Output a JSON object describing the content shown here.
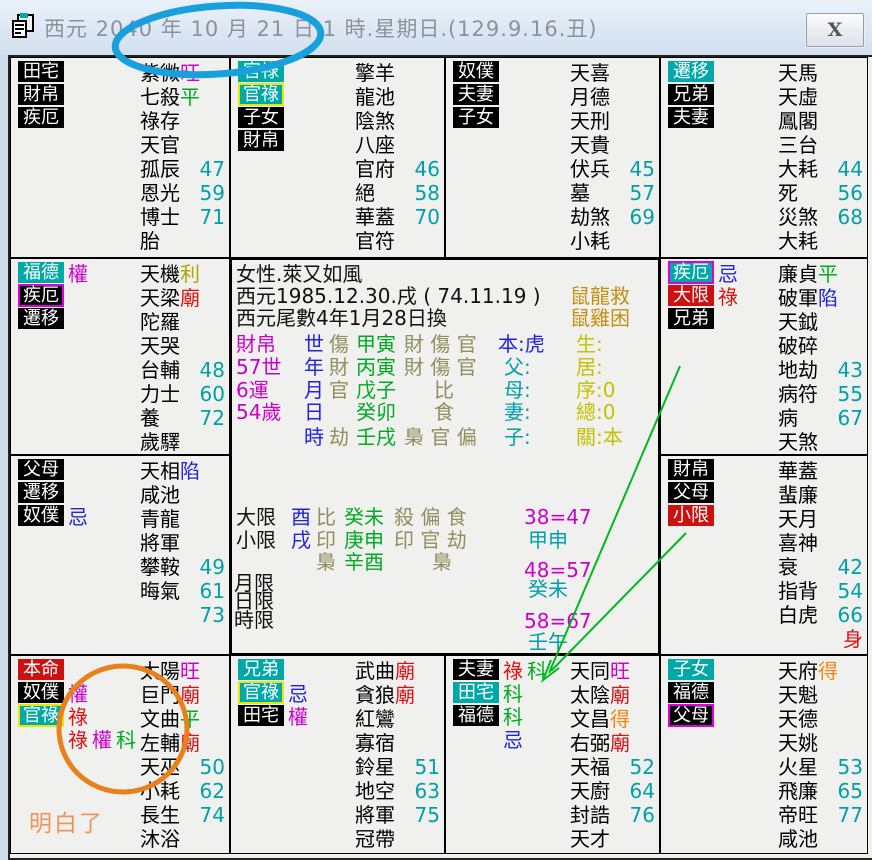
{
  "titlebar": {
    "title": "西元 2040 年 10 月 21 日 1 時.星期日.(129.9.16.丑)",
    "close_label": "X"
  },
  "colors": {
    "black": "#111111",
    "magenta": "#CC00CC",
    "red": "#DD1111",
    "green": "#00AA22",
    "blue": "#2222DD",
    "cyan": "#00A0A8",
    "orange": "#EE8811",
    "olive": "#8F8F5F",
    "gold": "#C09010",
    "yellow": "#C2C200",
    "darkyellow": "#A8A800",
    "noteorange": "#F0955A"
  },
  "annotations": {
    "blue_ellipse_color": "#18A0DC",
    "orange_circle_color": "#E8801E",
    "green_arrow_color": "#00B91E"
  },
  "cells": [
    {
      "id": "si",
      "boxes": [
        {
          "t": "田宅",
          "bg": "black",
          "marks": []
        },
        {
          "t": "財帛",
          "bg": "black",
          "marks": []
        },
        {
          "t": "疾厄",
          "bg": "black",
          "marks": []
        }
      ],
      "stars": [
        {
          "n": "紫微",
          "b": "旺",
          "bc": "magenta"
        },
        {
          "n": "七殺",
          "b": "平",
          "bc": "green"
        },
        {
          "n": "祿存"
        },
        {
          "n": "天官"
        },
        {
          "n": "孤辰",
          "num": "47"
        },
        {
          "n": "恩光",
          "num": "59"
        },
        {
          "n": "博士",
          "num": "71"
        },
        {
          "n": "胎"
        }
      ]
    },
    {
      "id": "wu",
      "boxes": [
        {
          "t": "官祿",
          "bg": "teal",
          "marks": []
        },
        {
          "t": "官祿",
          "bg": "teal",
          "border": "yellow",
          "marks": []
        },
        {
          "t": "子女",
          "bg": "black",
          "marks": []
        },
        {
          "t": "財帛",
          "bg": "black",
          "marks": []
        }
      ],
      "stars": [
        {
          "n": "擎羊"
        },
        {
          "n": "龍池"
        },
        {
          "n": "陰煞"
        },
        {
          "n": "八座"
        },
        {
          "n": "官府",
          "num": "46"
        },
        {
          "n": "絕",
          "num": "58"
        },
        {
          "n": "華蓋",
          "num": "70"
        },
        {
          "n": "官符"
        }
      ]
    },
    {
      "id": "wei",
      "boxes": [
        {
          "t": "奴僕",
          "bg": "black",
          "marks": []
        },
        {
          "t": "夫妻",
          "bg": "black",
          "marks": []
        },
        {
          "t": "子女",
          "bg": "black",
          "marks": []
        }
      ],
      "stars": [
        {
          "n": "天喜"
        },
        {
          "n": "月德"
        },
        {
          "n": "天刑"
        },
        {
          "n": "天貴"
        },
        {
          "n": "伏兵",
          "num": "45"
        },
        {
          "n": "墓",
          "num": "57"
        },
        {
          "n": "劫煞",
          "num": "69"
        },
        {
          "n": "小耗"
        }
      ]
    },
    {
      "id": "shen",
      "boxes": [
        {
          "t": "遷移",
          "bg": "teal",
          "marks": []
        },
        {
          "t": "兄弟",
          "bg": "black",
          "marks": []
        },
        {
          "t": "夫妻",
          "bg": "black",
          "marks": []
        }
      ],
      "stars": [
        {
          "n": "天馬"
        },
        {
          "n": "天虛"
        },
        {
          "n": "鳳閣"
        },
        {
          "n": "三台"
        },
        {
          "n": "大耗",
          "num": "44"
        },
        {
          "n": "死",
          "num": "56"
        },
        {
          "n": "災煞",
          "num": "68"
        },
        {
          "n": "大耗"
        }
      ]
    },
    {
      "id": "chen",
      "boxes": [
        {
          "t": "福德",
          "bg": "teal",
          "marks": [
            {
              "t": "權",
              "c": "magenta"
            }
          ]
        },
        {
          "t": "疾厄",
          "bg": "black",
          "border": "magenta",
          "marks": []
        },
        {
          "t": "遷移",
          "bg": "black",
          "marks": []
        }
      ],
      "stars": [
        {
          "n": "天機",
          "b": "利",
          "bc": "darkyellow"
        },
        {
          "n": "天梁",
          "b": "廟",
          "bc": "red"
        },
        {
          "n": "陀羅"
        },
        {
          "n": "天哭"
        },
        {
          "n": "台輔",
          "num": "48"
        },
        {
          "n": "力士",
          "num": "60"
        },
        {
          "n": "養",
          "num": "72"
        },
        {
          "n": "歲驛"
        }
      ]
    },
    {
      "id": "you",
      "boxes": [
        {
          "t": "疾厄",
          "bg": "teal",
          "border": "magenta",
          "marks": [
            {
              "t": "忌",
              "c": "blue"
            }
          ]
        },
        {
          "t": "大限",
          "bg": "red",
          "marks": [
            {
              "t": "祿",
              "c": "red"
            }
          ]
        },
        {
          "t": "兄弟",
          "bg": "black",
          "marks": []
        }
      ],
      "stars": [
        {
          "n": "廉貞",
          "b": "平",
          "bc": "green"
        },
        {
          "n": "破軍",
          "b": "陷",
          "bc": "blue"
        },
        {
          "n": "天鉞"
        },
        {
          "n": "破碎"
        },
        {
          "n": "地劫",
          "num": "43"
        },
        {
          "n": "病符",
          "num": "55"
        },
        {
          "n": "病",
          "num": "67"
        },
        {
          "n": "天煞"
        }
      ]
    },
    {
      "id": "mao",
      "boxes": [
        {
          "t": "父母",
          "bg": "black",
          "marks": []
        },
        {
          "t": "遷移",
          "bg": "black",
          "marks": []
        },
        {
          "t": "奴僕",
          "bg": "black",
          "marks": [
            {
              "t": "忌",
              "c": "blue"
            }
          ]
        }
      ],
      "stars": [
        {
          "n": "天相",
          "b": "陷",
          "bc": "blue"
        },
        {
          "n": "咸池"
        },
        {
          "n": "青龍"
        },
        {
          "n": "將軍"
        },
        {
          "n": "攀鞍",
          "num": "49"
        },
        {
          "n": "晦氣",
          "num": "61"
        },
        {
          "n": "",
          "num": "73"
        }
      ]
    },
    {
      "id": "xu",
      "boxes": [
        {
          "t": "財帛",
          "bg": "black",
          "marks": []
        },
        {
          "t": "父母",
          "bg": "black",
          "marks": []
        },
        {
          "t": "小限",
          "bg": "red",
          "marks": []
        }
      ],
      "stars": [
        {
          "n": "華蓋"
        },
        {
          "n": "蜚廉"
        },
        {
          "n": "天月"
        },
        {
          "n": "喜神"
        },
        {
          "n": "衰",
          "num": "42"
        },
        {
          "n": "指背",
          "num": "54"
        },
        {
          "n": "白虎",
          "num": "66"
        },
        {
          "n": "",
          "num": "身",
          "numc": "red"
        }
      ]
    },
    {
      "id": "yin",
      "boxes": [
        {
          "t": "本命",
          "bg": "red",
          "marks": []
        },
        {
          "t": "奴僕",
          "bg": "black",
          "marks": [
            {
              "t": "權",
              "c": "magenta"
            }
          ]
        },
        {
          "t": "官祿",
          "bg": "teal",
          "border": "yellow",
          "marks": [
            {
              "t": "祿",
              "c": "red"
            }
          ]
        },
        {
          "bg": "none",
          "marks": [
            {
              "t": "祿",
              "c": "red"
            },
            {
              "t": "權",
              "c": "magenta"
            },
            {
              "t": "科",
              "c": "green"
            }
          ]
        }
      ],
      "note": {
        "t": "明白了",
        "c": "noteorange"
      },
      "stars": [
        {
          "n": "太陽",
          "b": "旺",
          "bc": "magenta"
        },
        {
          "n": "巨門",
          "b": "廟",
          "bc": "red"
        },
        {
          "n": "文曲",
          "b": "平",
          "bc": "green"
        },
        {
          "n": "左輔",
          "b": "廟",
          "bc": "red"
        },
        {
          "n": "天巫",
          "num": "50"
        },
        {
          "n": "小耗",
          "num": "62"
        },
        {
          "n": "長生",
          "num": "74"
        },
        {
          "n": "沐浴"
        }
      ]
    },
    {
      "id": "chou",
      "boxes": [
        {
          "t": "兄弟",
          "bg": "teal",
          "marks": []
        },
        {
          "t": "官祿",
          "bg": "teal",
          "border": "yellow",
          "marks": [
            {
              "t": "忌",
              "c": "blue"
            }
          ]
        },
        {
          "t": "田宅",
          "bg": "black",
          "marks": [
            {
              "t": "權",
              "c": "magenta"
            }
          ]
        }
      ],
      "stars": [
        {
          "n": "武曲",
          "b": "廟",
          "bc": "red"
        },
        {
          "n": "貪狼",
          "b": "廟",
          "bc": "red"
        },
        {
          "n": "紅鸞"
        },
        {
          "n": "寡宿"
        },
        {
          "n": "鈴星",
          "num": "51"
        },
        {
          "n": "地空",
          "num": "63"
        },
        {
          "n": "將軍",
          "num": "75"
        },
        {
          "n": "冠帶"
        }
      ]
    },
    {
      "id": "zi",
      "boxes": [
        {
          "t": "夫妻",
          "bg": "black",
          "marks": [
            {
              "t": "祿",
              "c": "red"
            },
            {
              "t": "科",
              "c": "green"
            }
          ]
        },
        {
          "t": "田宅",
          "bg": "teal",
          "marks": [
            {
              "t": "科",
              "c": "green"
            }
          ]
        },
        {
          "t": "福德",
          "bg": "black",
          "marks": [
            {
              "t": "科",
              "c": "green"
            }
          ]
        },
        {
          "bg": "none",
          "marks": [
            {
              "t": "忌",
              "c": "blue"
            }
          ]
        }
      ],
      "stars": [
        {
          "n": "天同",
          "b": "旺",
          "bc": "magenta"
        },
        {
          "n": "太陰",
          "b": "廟",
          "bc": "red"
        },
        {
          "n": "文昌",
          "b": "得",
          "bc": "orange"
        },
        {
          "n": "右弼",
          "b": "廟",
          "bc": "red"
        },
        {
          "n": "天福",
          "num": "52"
        },
        {
          "n": "天廚",
          "num": "64"
        },
        {
          "n": "封誥",
          "num": "76"
        },
        {
          "n": "天才"
        }
      ]
    },
    {
      "id": "hai",
      "boxes": [
        {
          "t": "子女",
          "bg": "teal",
          "marks": []
        },
        {
          "t": "福德",
          "bg": "black",
          "marks": []
        },
        {
          "t": "父母",
          "bg": "black",
          "border": "magenta",
          "marks": []
        }
      ],
      "stars": [
        {
          "n": "天府",
          "b": "得",
          "bc": "orange"
        },
        {
          "n": "天魁"
        },
        {
          "n": "天德"
        },
        {
          "n": "天姚"
        },
        {
          "n": "火星",
          "num": "53"
        },
        {
          "n": "飛廉",
          "num": "65"
        },
        {
          "n": "帝旺",
          "num": "77"
        },
        {
          "n": "咸池"
        }
      ]
    }
  ],
  "center": {
    "lines": [
      {
        "segs": [
          {
            "t": "女性.萊又如風",
            "c": "black"
          }
        ]
      },
      {
        "segs": [
          {
            "t": "西元1985.12.30.戌 ( 74.11.19 )",
            "c": "black"
          },
          {
            "t": "鼠龍救",
            "c": "gold"
          }
        ]
      },
      {
        "segs": [
          {
            "t": "西元尾數4年1月28日換",
            "c": "black"
          },
          {
            "t": "鼠雞困",
            "c": "gold"
          }
        ]
      },
      {
        "segs": [
          {
            "t": "財帛",
            "c": "magenta"
          },
          {
            "t": "世",
            "c": "blue"
          },
          {
            "t": "傷",
            "c": "olive"
          },
          {
            "t": "甲寅",
            "c": "green"
          },
          {
            "t": "財 傷 官",
            "c": "olive"
          },
          {
            "t": "本:虎",
            "c": "blue"
          },
          {
            "t": "生:",
            "c": "yellow"
          }
        ]
      },
      {
        "segs": [
          {
            "t": "57世",
            "c": "magenta"
          },
          {
            "t": "年",
            "c": "blue"
          },
          {
            "t": "財",
            "c": "olive"
          },
          {
            "t": "丙寅",
            "c": "green"
          },
          {
            "t": "財 傷 官",
            "c": "olive"
          },
          {
            "t": "父:",
            "c": "cyan"
          },
          {
            "t": "居:",
            "c": "yellow"
          }
        ]
      },
      {
        "segs": [
          {
            "t": "6運",
            "c": "magenta"
          },
          {
            "t": "月",
            "c": "blue"
          },
          {
            "t": "官",
            "c": "olive"
          },
          {
            "t": "戊子",
            "c": "green"
          },
          {
            "t": "比",
            "c": "olive"
          },
          {
            "t": "母:",
            "c": "cyan"
          },
          {
            "t": "序:0",
            "c": "yellow"
          }
        ]
      },
      {
        "segs": [
          {
            "t": "54歲",
            "c": "magenta"
          },
          {
            "t": "日",
            "c": "blue"
          },
          {
            "t": "癸卯",
            "c": "green"
          },
          {
            "t": "食",
            "c": "olive"
          },
          {
            "t": "妻:",
            "c": "cyan"
          },
          {
            "t": "總:0",
            "c": "yellow"
          }
        ]
      },
      {
        "segs": [
          {
            "t": "時",
            "c": "blue"
          },
          {
            "t": "劫",
            "c": "olive"
          },
          {
            "t": "壬戌",
            "c": "green"
          },
          {
            "t": "梟 官 偏",
            "c": "olive"
          },
          {
            "t": "子:",
            "c": "cyan"
          },
          {
            "t": "關:本",
            "c": "yellow"
          }
        ]
      },
      {
        "segs": [
          {
            "t": "大限",
            "c": "black"
          },
          {
            "t": "酉",
            "c": "blue"
          },
          {
            "t": "比",
            "c": "olive"
          },
          {
            "t": "癸未",
            "c": "green"
          },
          {
            "t": "殺 偏 食",
            "c": "olive"
          },
          {
            "t": "38=47",
            "c": "magenta"
          }
        ]
      },
      {
        "segs": [
          {
            "t": "小限",
            "c": "black"
          },
          {
            "t": "戌",
            "c": "blue"
          },
          {
            "t": "印",
            "c": "olive"
          },
          {
            "t": "庚申",
            "c": "green"
          },
          {
            "t": "印 官 劫",
            "c": "olive"
          },
          {
            "t": "甲申",
            "c": "cyan"
          }
        ]
      },
      {
        "segs": [
          {
            "t": "梟",
            "c": "olive"
          },
          {
            "t": "辛酉",
            "c": "green"
          },
          {
            "t": "梟",
            "c": "olive"
          },
          {
            "t": "48=57",
            "c": "magenta"
          }
        ]
      },
      {
        "segs": [
          {
            "t": "月限",
            "c": "black"
          },
          {
            "t": "癸未",
            "c": "cyan"
          }
        ]
      },
      {
        "segs": [
          {
            "t": "日限",
            "c": "black"
          }
        ]
      },
      {
        "segs": [
          {
            "t": "時限",
            "c": "black"
          },
          {
            "t": "58=67",
            "c": "magenta"
          }
        ]
      },
      {
        "segs": [
          {
            "t": "壬午",
            "c": "cyan"
          }
        ]
      }
    ]
  }
}
